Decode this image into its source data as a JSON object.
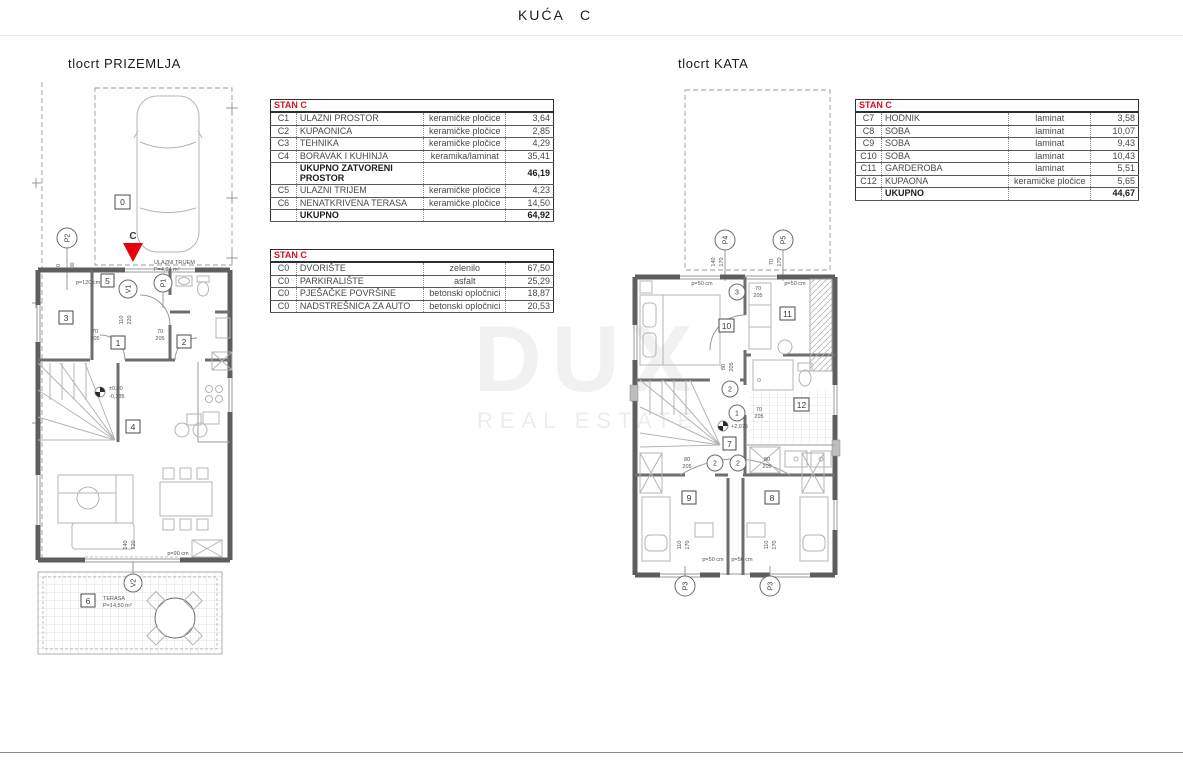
{
  "title": "KUĆA C",
  "colors": {
    "accent": "#d70f1e",
    "wall": "#5e5e5e",
    "watermark": "#f1f1f1"
  },
  "watermark": {
    "line1": "DUX",
    "line2": "REAL ESTATE"
  },
  "plans": {
    "ground": {
      "label": "tlocrt PRIZEMLJA"
    },
    "upper": {
      "label": "tlocrt KATA"
    }
  },
  "ground_labels": {
    "carport": "0",
    "entry_letter": "C",
    "p2": "P2",
    "v1": "V1",
    "p1": "P1",
    "v2": "V2",
    "n1": "1",
    "n2": "2",
    "n3": "3",
    "n4": "4",
    "n5": "5",
    "n6": "6",
    "trijem1": "ULAZNI TRIJEM",
    "trijem2": "P=4,24 m²",
    "terasa1": "TERASA",
    "terasa2": "P=14,50 m²",
    "p120": "p=120 cm",
    "p90": "p=90 cm",
    "d70": "70",
    "d205": "205",
    "d110": "110",
    "d220": "220",
    "d100": "100",
    "d140": "140",
    "lvl0": "±0,00",
    "lvlm": "-0,185"
  },
  "upper_labels": {
    "p3": "P3",
    "p4": "P4",
    "p5": "P5",
    "n7": "7",
    "n8": "8",
    "n9": "9",
    "n10": "10",
    "n11": "11",
    "n12": "12",
    "c1": "1",
    "c2": "2",
    "c3": "3",
    "d70": "70",
    "d80": "80",
    "d110": "110",
    "d140": "140",
    "d170": "170",
    "d205": "205",
    "p50": "p=50 cm",
    "lvl": "+2,975"
  },
  "tables": [
    {
      "title": "STAN C",
      "rows": [
        {
          "code": "C1",
          "name": "ULAZNI PROSTOR",
          "material": "keramičke pločice",
          "value": "3,64"
        },
        {
          "code": "C2",
          "name": "KUPAONICA",
          "material": "keramičke pločice",
          "value": "2,85"
        },
        {
          "code": "C3",
          "name": "TEHNIKA",
          "material": "keramičke pločice",
          "value": "4,29"
        },
        {
          "code": "C4",
          "name": "BORAVAK I KUHINJA",
          "material": "keramika/laminat",
          "value": "35,41"
        },
        {
          "code": "",
          "name": "UKUPNO ZATVORENI PROSTOR",
          "material": "",
          "value": "46,19",
          "bold": true
        },
        {
          "code": "C5",
          "name": "ULAZNI TRIJEM",
          "material": "keramičke pločice",
          "value": "4,23"
        },
        {
          "code": "C6",
          "name": "NENATKRIVENA TERASA",
          "material": "keramičke pločice",
          "value": "14,50"
        },
        {
          "code": "",
          "name": "UKUPNO",
          "material": "",
          "value": "64,92",
          "bold": true
        }
      ]
    },
    {
      "title": "STAN C",
      "rows": [
        {
          "code": "C0",
          "name": "DVORIŠTE",
          "material": "zelenilo",
          "value": "67,50"
        },
        {
          "code": "C0",
          "name": "PARKIRALIŠTE",
          "material": "asfalt",
          "value": "25,29"
        },
        {
          "code": "C0",
          "name": "PJEŠAČKE POVRŠINE",
          "material": "betonski opločnici",
          "value": "18,87"
        },
        {
          "code": "C0",
          "name": "NADSTREŠNICA ZA AUTO",
          "material": "betonski opločnici",
          "value": "20,53"
        }
      ]
    },
    {
      "title": "STAN C",
      "rows": [
        {
          "code": "C7",
          "name": "HODNIK",
          "material": "laminat",
          "value": "3,58"
        },
        {
          "code": "C8",
          "name": "SOBA",
          "material": "laminat",
          "value": "10,07"
        },
        {
          "code": "C9",
          "name": "SOBA",
          "material": "laminat",
          "value": "9,43"
        },
        {
          "code": "C10",
          "name": "SOBA",
          "material": "laminat",
          "value": "10,43"
        },
        {
          "code": "C11",
          "name": "GARDEROBA",
          "material": "laminat",
          "value": "5,51"
        },
        {
          "code": "C12",
          "name": "KUPAONA",
          "material": "keramičke pločice",
          "value": "5,65"
        },
        {
          "code": "",
          "name": "UKUPNO",
          "material": "",
          "value": "44,67",
          "bold": true
        }
      ]
    }
  ]
}
